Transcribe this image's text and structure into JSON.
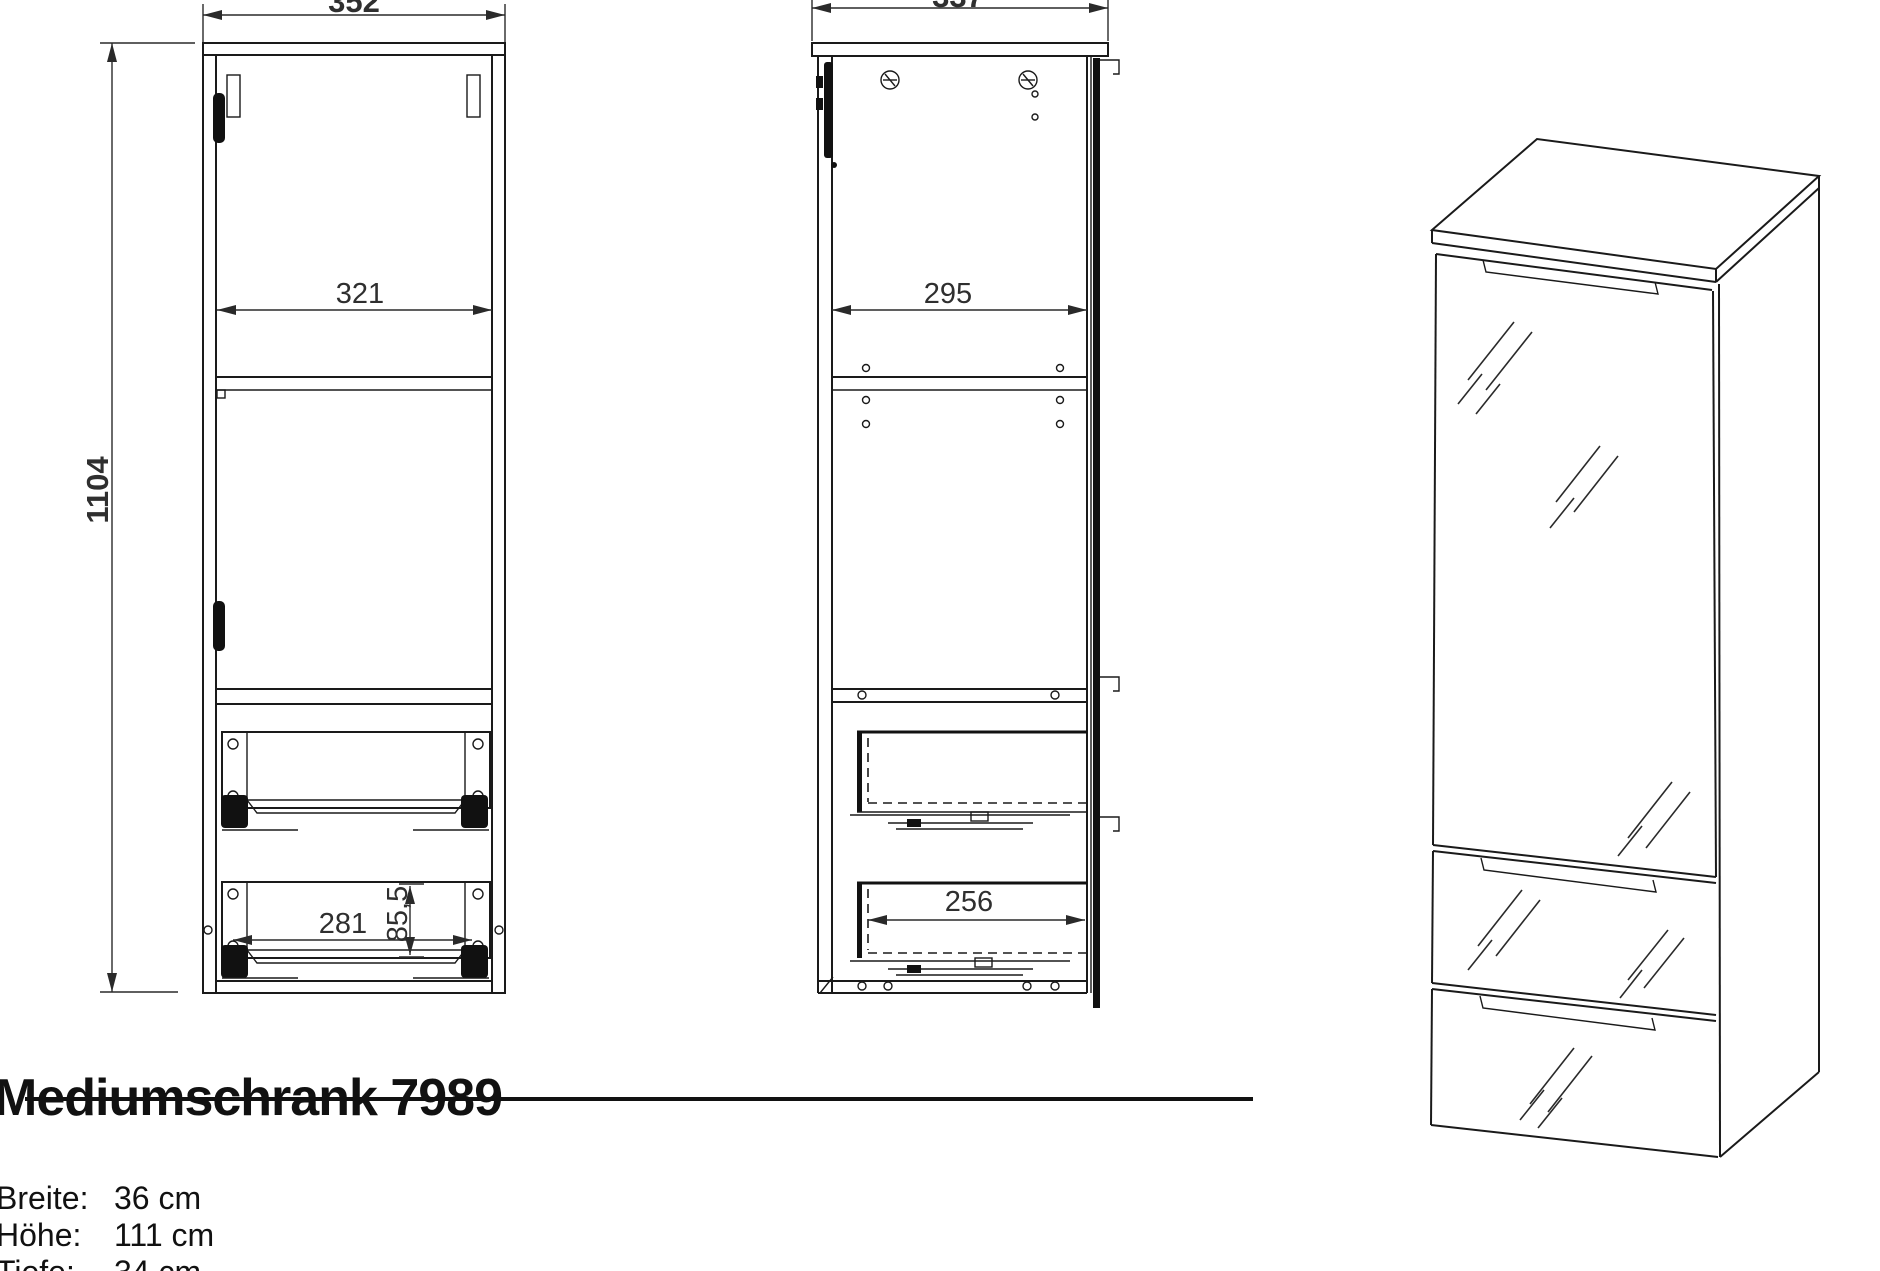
{
  "title": "Mediumschrank 7989",
  "specs": [
    {
      "label": "Breite:",
      "value": "36 cm"
    },
    {
      "label": "Höhe:",
      "value": "111 cm"
    },
    {
      "label": "Tiefe:",
      "value": "34 cm"
    }
  ],
  "dimensions": {
    "front_width": "352",
    "front_inner_width": "321",
    "height": "1104",
    "drawer_width": "281",
    "drawer_height": "85,5",
    "side_depth": "337",
    "side_inner_depth": "295",
    "side_drawer_depth": "256"
  },
  "colors": {
    "line": "#1a1a1a",
    "background": "#ffffff"
  }
}
